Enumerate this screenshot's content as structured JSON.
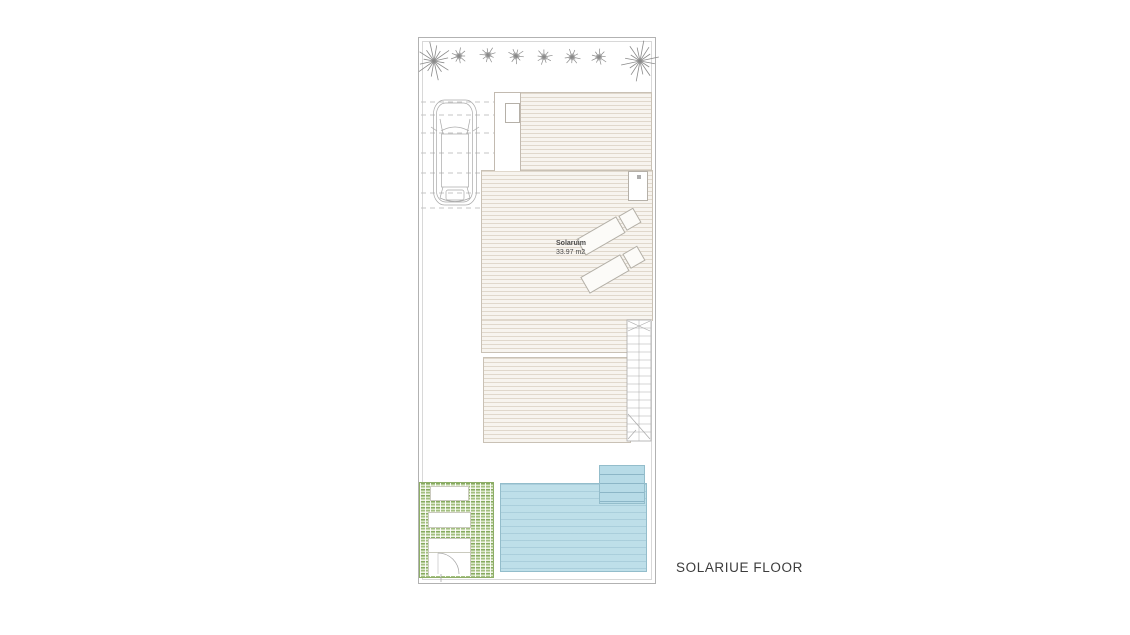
{
  "drawing": {
    "floor_label": "SOLARIUE FLOOR",
    "room_label": {
      "name": "Solaruim",
      "area": "33.97 m2"
    }
  },
  "colors": {
    "line_gray": "#a9a9a9",
    "dash_gray": "#c4c4c4",
    "tree_gray": "#8a8a8a",
    "deck_line": "#c9c1b5",
    "pool_fill": "#bedfe9",
    "pool_edge": "#93bdcb",
    "grass_green": "#87aa60",
    "text_dark": "#3c3c3c"
  },
  "plan": {
    "trees_large": [
      {
        "x": 434,
        "y": 61,
        "r": 21
      },
      {
        "x": 640,
        "y": 61,
        "r": 22
      }
    ],
    "trees_small": [
      {
        "x": 459,
        "y": 56,
        "r": 9
      },
      {
        "x": 488,
        "y": 55,
        "r": 9
      },
      {
        "x": 516,
        "y": 56,
        "r": 9
      },
      {
        "x": 544,
        "y": 57,
        "r": 9
      },
      {
        "x": 572,
        "y": 57,
        "r": 9
      },
      {
        "x": 599,
        "y": 57,
        "r": 9
      }
    ],
    "parking_dashes": [
      {
        "y": 102,
        "x1": 421,
        "x2": 494
      },
      {
        "y": 115,
        "x1": 421,
        "x2": 494
      },
      {
        "y": 133,
        "x1": 421,
        "x2": 494
      },
      {
        "y": 153,
        "x1": 421,
        "x2": 494
      },
      {
        "y": 173,
        "x1": 421,
        "x2": 481
      },
      {
        "y": 193,
        "x1": 421,
        "x2": 481
      },
      {
        "y": 208,
        "x1": 421,
        "x2": 481
      }
    ],
    "car": {
      "x": 433,
      "y": 100,
      "w": 44,
      "h": 105
    },
    "stairs": {
      "x": 627,
      "y": 320,
      "w": 24,
      "h": 121,
      "tread_start": 328,
      "tread_step": 8,
      "tread_count": 14
    },
    "gate_arc": {
      "x": 438,
      "y": 553,
      "r": 21
    }
  }
}
